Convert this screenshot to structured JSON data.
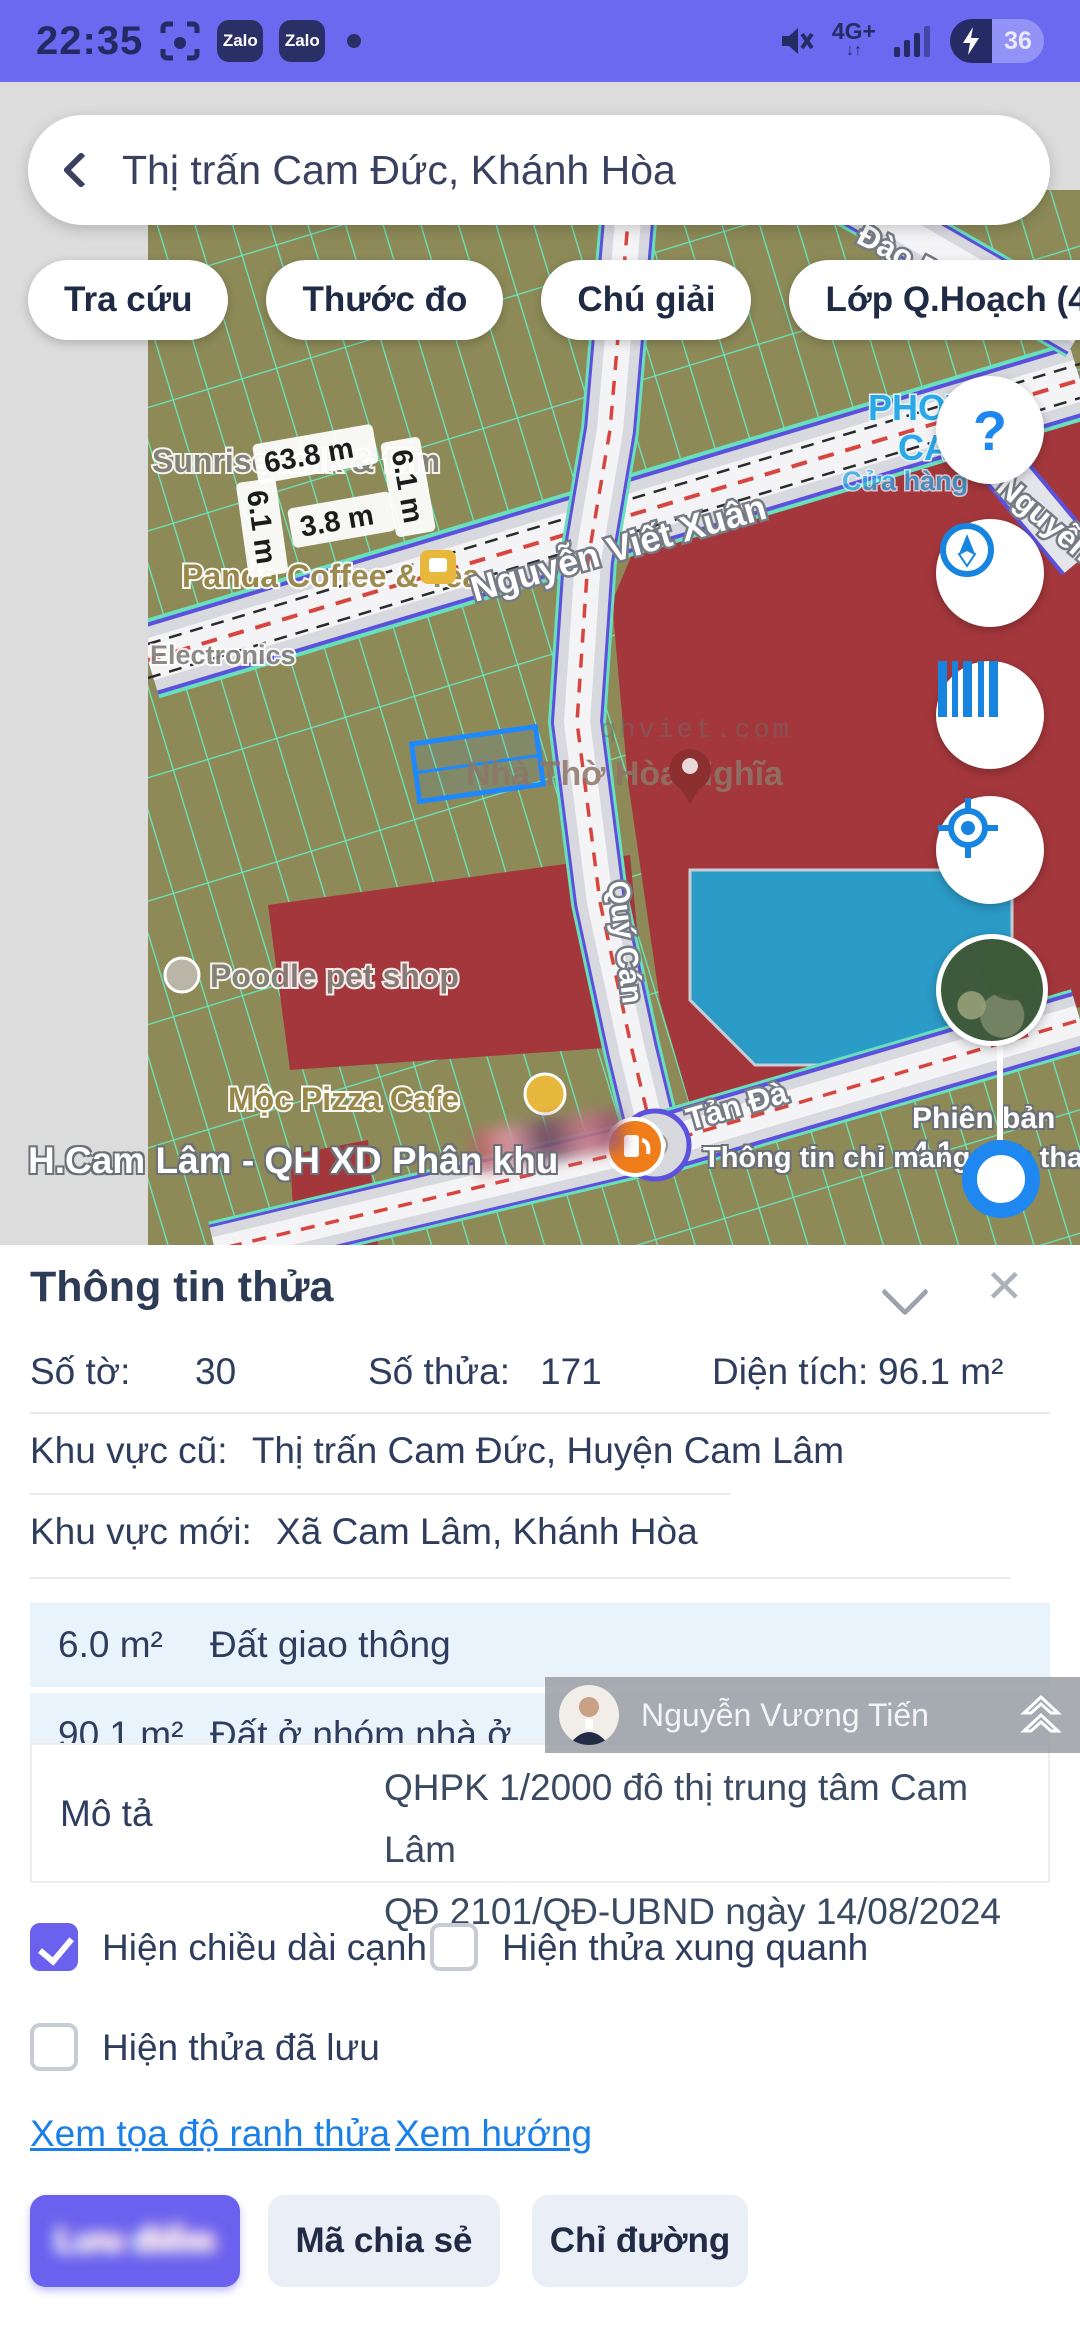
{
  "colors": {
    "accent_purple": "#6A61EE",
    "status_bg": "#6A69F0",
    "link_blue": "#1B7FE8",
    "zone_red": "#A4373C",
    "zone_blue": "#2B9BC8",
    "land_olive": "#8D8A58",
    "parcel_teal": "#68E7BD"
  },
  "status_bar": {
    "time": "22:35",
    "zalo": "Zalo",
    "network": "4G+",
    "battery": "36"
  },
  "search": {
    "query": "Thị trấn Cam Đức, Khánh Hòa"
  },
  "map_toolbar": {
    "buttons": [
      "Tra cứu",
      "Thước đo",
      "Chú giải",
      "Lớp Q.Hoạch (4)"
    ]
  },
  "map": {
    "streets": {
      "main": "Nguyễn Viết Xuân",
      "south": "Tản Đà",
      "vertical": "Quý Cán",
      "topright": "Đào Duy Anh",
      "right": "Nguyễn"
    },
    "pois": {
      "shop1": "Sunrise milk & film",
      "shop2": "Panda Coffee & Tea",
      "shop3": "Electronics",
      "shop4": "Poodle pet shop",
      "shop5": "Mộc Pizza Cafe",
      "church": "Nhà Thờ Hòa Nghĩa",
      "photo1": "PHOT",
      "photo2": "CA",
      "photo3": "Cửa hàng",
      "watermark": "qhviet.com"
    },
    "measurements": [
      "63.8 m",
      "6.1 m",
      "3.8 m",
      "6.1 m"
    ],
    "overlay_left": "H.Cam Lâm - QH XD Phân khu",
    "version": "Phiên bản 4.1",
    "disclaimer": "Thông tin chỉ mang tính tham khảo"
  },
  "sheet": {
    "title": "Thông tin thửa",
    "fields": {
      "so_to_label": "Số tờ:",
      "so_to": "30",
      "so_thua_label": "Số thửa:",
      "so_thua": "171",
      "dien_tich_label": "Diện tích:",
      "dien_tich": "96.1 m²"
    },
    "khu_vuc_cu_label": "Khu vực cũ:",
    "khu_vuc_cu": "Thị trấn Cam Đức, Huyện Cam Lâm",
    "khu_vuc_moi_label": "Khu vực mới:",
    "khu_vuc_moi": "Xã Cam Lâm, Khánh Hòa",
    "land_rows": [
      {
        "area": "6.0 m²",
        "type": "Đất giao thông"
      },
      {
        "area": "90.1 m²",
        "type": "Đất ở nhóm nhà ở"
      }
    ],
    "mo_ta_label": "Mô tả",
    "mo_ta_line1": "QHPK 1/2000 đô thị trung tâm Cam Lâm",
    "mo_ta_line2": "QĐ 2101/QĐ-UBND ngày 14/08/2024",
    "checkboxes": [
      {
        "label": "Hiện chiều dài cạnh",
        "checked": true
      },
      {
        "label": "Hiện thửa xung quanh",
        "checked": false
      },
      {
        "label": "Hiện thửa đã lưu",
        "checked": false
      }
    ],
    "links": {
      "coords": "Xem tọa độ ranh thửa",
      "direction": "Xem hướng"
    },
    "buttons": {
      "primary": "Lưu điểm",
      "share": "Mã chia sẻ",
      "directions": "Chỉ đường"
    },
    "user_overlay": {
      "name": "Nguyễn Vương Tiến"
    }
  }
}
